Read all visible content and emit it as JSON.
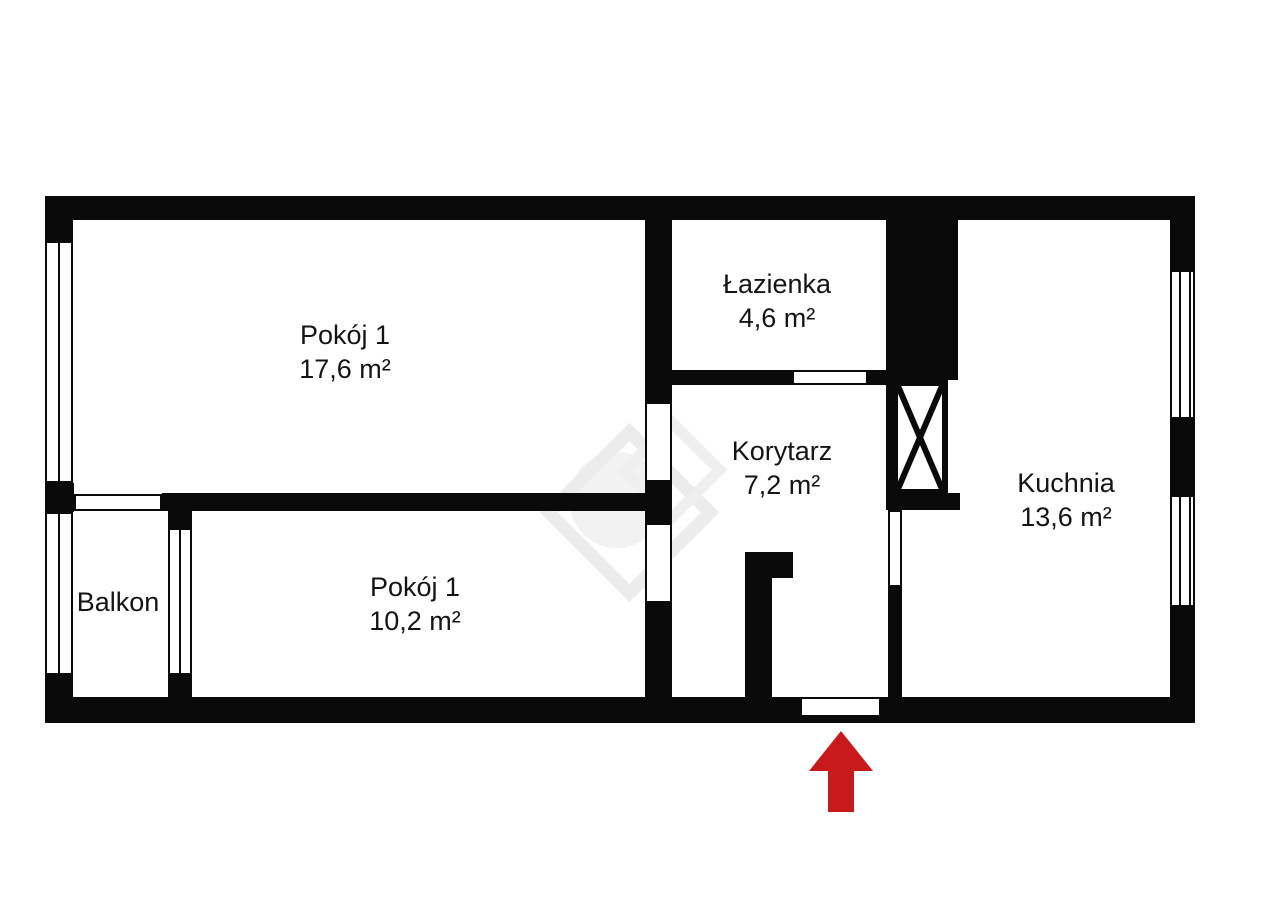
{
  "page": {
    "background": "#ffffff"
  },
  "floorplan": {
    "type": "apartment-floor-plan",
    "wall_color": "#0a0a0a",
    "floor_color": "#ffffff",
    "watermark_color": "#ededed",
    "entrance_arrow_color": "#c81a1a",
    "rooms": [
      {
        "id": "pokoj-1-gorny",
        "label": "Pokój 1",
        "area": "17,6 m²"
      },
      {
        "id": "lazienka",
        "label": "Łazienka",
        "area": "4,6 m²"
      },
      {
        "id": "korytarz",
        "label": "Korytarz",
        "area": "7,2 m²"
      },
      {
        "id": "kuchnia",
        "label": "Kuchnia",
        "area": "13,6 m²"
      },
      {
        "id": "pokoj-1-dolny",
        "label": "Pokój 1",
        "area": "10,2 m²"
      },
      {
        "id": "balkon",
        "label": "Balkon",
        "area": ""
      }
    ]
  }
}
